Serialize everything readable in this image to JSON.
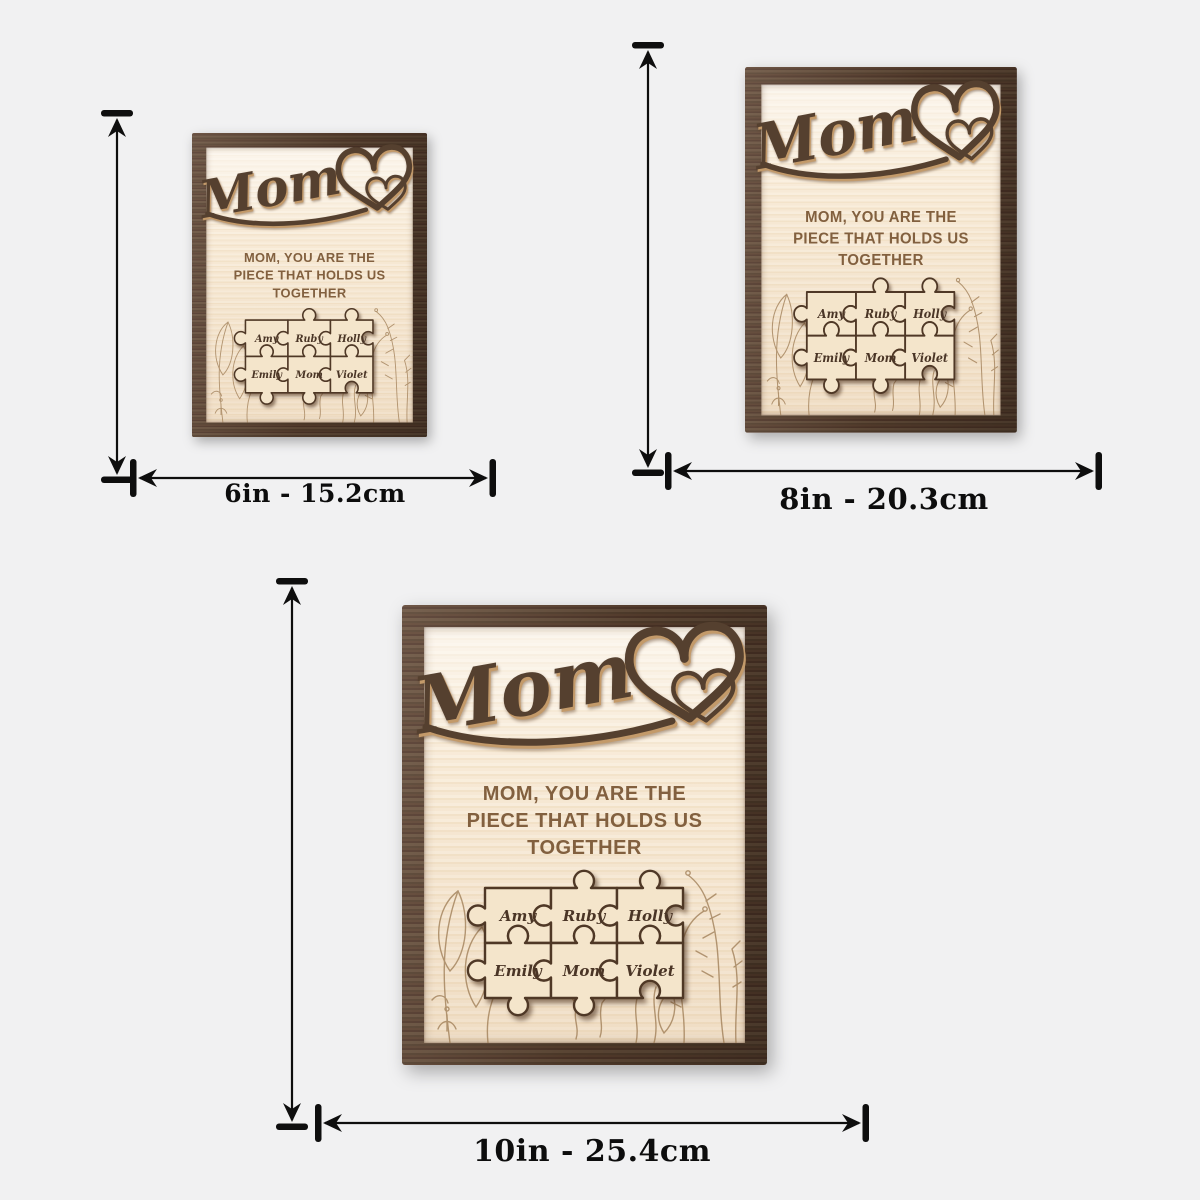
{
  "page": {
    "background": "#f1f1f2"
  },
  "plaque": {
    "title": "Mom",
    "subtitle": {
      "line1": "MOM, YOU ARE THE",
      "line2": "PIECE THAT HOLDS US",
      "line3": "TOGETHER"
    },
    "names": [
      "Amy",
      "Ruby",
      "Holly",
      "Emily",
      "Mom",
      "Violet"
    ],
    "colors": {
      "frame_wood": "#583e2e",
      "panel_wood": "#f5e7d0",
      "dark_accent": "#55402f",
      "engraved_text": "#82603f",
      "floral_line": "#9c7a52",
      "puzzle_fill": "#f4e5cb"
    }
  },
  "sizes": [
    {
      "name": "6 inch",
      "label": "6in - 15.2cm"
    },
    {
      "name": "8 inch",
      "label": "8in - 20.3cm"
    },
    {
      "name": "10 inch",
      "label": "10in - 25.4cm"
    }
  ]
}
